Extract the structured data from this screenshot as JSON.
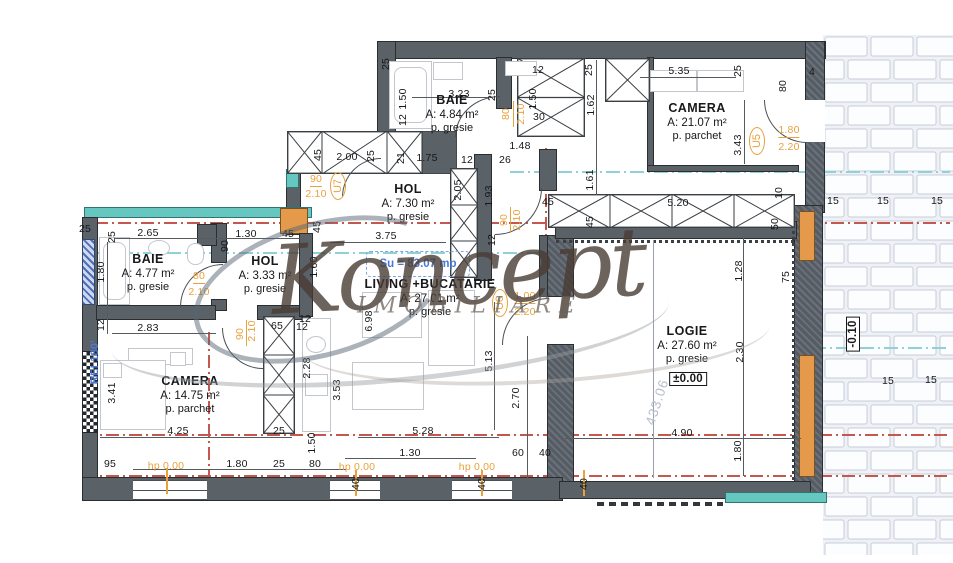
{
  "watermark": {
    "brand": "Koncept",
    "subtitle": "IMOBILIARE"
  },
  "summary": {
    "usable_area": "Su = 83.07 mp"
  },
  "colors": {
    "accent_orange": "#e8a23c",
    "accent_blue": "#4a78d6",
    "section_red": "#c4574e",
    "section_cyan": "#8ed2d8",
    "insulation_teal": "#66c7c1",
    "wall_gray": "#5a6167"
  },
  "rooms": [
    {
      "id": "baie-top",
      "name": "BAIE",
      "area": "A: 4.84 m²",
      "floor": "p. gresie",
      "x": 452,
      "y": 93
    },
    {
      "id": "camera-top",
      "name": "CAMERA",
      "area": "A: 21.07 m²",
      "floor": "p. parchet",
      "x": 697,
      "y": 101
    },
    {
      "id": "hol-top",
      "name": "HOL",
      "area": "A: 7.30 m²",
      "floor": "p. gresie",
      "x": 408,
      "y": 182
    },
    {
      "id": "baie-left",
      "name": "BAIE",
      "area": "A: 4.77 m²",
      "floor": "p. gresie",
      "x": 148,
      "y": 252
    },
    {
      "id": "hol-left",
      "name": "HOL",
      "area": "A: 3.33 m²",
      "floor": "p. gresie",
      "x": 265,
      "y": 254
    },
    {
      "id": "camera-bottom",
      "name": "CAMERA",
      "area": "A: 14.75 m²",
      "floor": "p. parchet",
      "x": 190,
      "y": 374
    },
    {
      "id": "living",
      "name": "LIVING +BUCATARIE",
      "area": "A: 27.01 m²",
      "floor": "p. gresie",
      "x": 430,
      "y": 277
    },
    {
      "id": "logie",
      "name": "LOGIE",
      "area": "A: 27.60 m²",
      "floor": "p. gresie",
      "x": 687,
      "y": 324
    }
  ],
  "door_tags": [
    {
      "label": "U5",
      "x": 757,
      "y": 141
    },
    {
      "label": "U6",
      "x": 500,
      "y": 303
    },
    {
      "label": "U7",
      "x": 338,
      "y": 186
    }
  ],
  "levels": [
    {
      "text": "±0.00",
      "x": 688,
      "y": 379,
      "r": 0
    },
    {
      "text": "-0.10",
      "x": 853,
      "y": 334,
      "r": -90
    }
  ],
  "special": [
    {
      "text": "REI 180'",
      "x": 95,
      "y": 362,
      "r": -90,
      "cls": "b"
    },
    {
      "text": "433.06",
      "x": 657,
      "y": 402,
      "r": -72,
      "cls": "g"
    }
  ],
  "dims": [
    [
      "25",
      386,
      64,
      -90
    ],
    [
      "3.23",
      459,
      94,
      0
    ],
    [
      "25",
      492,
      95,
      -90
    ],
    [
      "1.50",
      403,
      99,
      -90
    ],
    [
      "12",
      403,
      120,
      -90
    ],
    [
      "1.50",
      533,
      99,
      -90
    ],
    [
      "12",
      538,
      70,
      0
    ],
    [
      "30",
      539,
      117,
      0
    ],
    [
      "25",
      589,
      70,
      -90
    ],
    [
      "1.62",
      591,
      105,
      -90
    ],
    [
      "1.61",
      590,
      180,
      -90
    ],
    [
      "5.35",
      679,
      71,
      0
    ],
    [
      "25",
      738,
      71,
      -90
    ],
    [
      "80",
      783,
      86,
      -90
    ],
    [
      "4",
      812,
      72,
      0
    ],
    [
      "3.43",
      738,
      145,
      -90
    ],
    [
      "1.48",
      520,
      146,
      0
    ],
    [
      "26",
      505,
      160,
      0
    ],
    [
      "2.00",
      347,
      157,
      0
    ],
    [
      "25",
      371,
      156,
      -90
    ],
    [
      "45",
      318,
      155,
      -90
    ],
    [
      "21",
      401,
      158,
      -90
    ],
    [
      "1.75",
      427,
      158,
      0
    ],
    [
      "12",
      467,
      160,
      0
    ],
    [
      "2.05",
      458,
      190,
      -90
    ],
    [
      "1.93",
      489,
      196,
      -90
    ],
    [
      "12",
      492,
      240,
      -90
    ],
    [
      "45",
      317,
      227,
      -90
    ],
    [
      "3.75",
      386,
      236,
      0
    ],
    [
      "25",
      85,
      229,
      0
    ],
    [
      "25",
      112,
      237,
      -90
    ],
    [
      "2.65",
      148,
      233,
      0
    ],
    [
      "1.30",
      246,
      234,
      0
    ],
    [
      "45",
      288,
      234,
      0
    ],
    [
      "90",
      225,
      246,
      -90
    ],
    [
      "1.80",
      101,
      272,
      -90
    ],
    [
      "12",
      101,
      325,
      -90
    ],
    [
      "2.83",
      148,
      328,
      0
    ],
    [
      "65",
      277,
      326,
      0
    ],
    [
      "12",
      302,
      327,
      0
    ],
    [
      "3.41",
      112,
      393,
      -90
    ],
    [
      "4.25",
      178,
      431,
      0
    ],
    [
      "25",
      279,
      431,
      0
    ],
    [
      "2.28",
      307,
      368,
      -90
    ],
    [
      "1.50",
      312,
      443,
      -90
    ],
    [
      "95",
      110,
      464,
      0
    ],
    [
      "1.80",
      237,
      464,
      0
    ],
    [
      "25",
      279,
      464,
      0
    ],
    [
      "80",
      315,
      464,
      0
    ],
    [
      "1.60",
      314,
      267,
      -90
    ],
    [
      "12",
      305,
      319,
      0
    ],
    [
      "6.98",
      369,
      321,
      -90
    ],
    [
      "3.53",
      337,
      390,
      -90
    ],
    [
      "5.28",
      423,
      431,
      0
    ],
    [
      "1.30",
      410,
      453,
      0
    ],
    [
      "5.13",
      489,
      361,
      -90
    ],
    [
      "2.70",
      516,
      398,
      -90
    ],
    [
      "60",
      518,
      453,
      0
    ],
    [
      "40",
      545,
      453,
      0
    ],
    [
      "40",
      356,
      484,
      -90
    ],
    [
      "40",
      482,
      484,
      -90
    ],
    [
      "40",
      584,
      484,
      -90
    ],
    [
      "45",
      548,
      202,
      0
    ],
    [
      "45",
      590,
      222,
      -90
    ],
    [
      "5.20",
      678,
      203,
      0
    ],
    [
      "10",
      779,
      193,
      -90
    ],
    [
      "50",
      775,
      224,
      -90
    ],
    [
      "1.28",
      739,
      271,
      -90
    ],
    [
      "2.30",
      740,
      352,
      -90
    ],
    [
      "75",
      786,
      277,
      -90
    ],
    [
      "4.90",
      682,
      433,
      0
    ],
    [
      "1.80",
      738,
      451,
      -90
    ],
    [
      "15",
      833,
      201,
      0
    ],
    [
      "15",
      883,
      201,
      0
    ],
    [
      "15",
      937,
      201,
      0
    ],
    [
      "15",
      888,
      381,
      0
    ],
    [
      "15",
      931,
      380,
      0
    ]
  ],
  "door_sizes": [
    [
      "80",
      506,
      114,
      -90,
      false
    ],
    [
      "2.10",
      521,
      114,
      -90,
      false
    ],
    [
      "90",
      316,
      180,
      0,
      true
    ],
    [
      "2.10",
      316,
      194,
      0,
      false
    ],
    [
      "80",
      199,
      277,
      0,
      true
    ],
    [
      "2.10",
      199,
      292,
      0,
      false
    ],
    [
      "90",
      240,
      334,
      -90,
      false
    ],
    [
      "2.10",
      252,
      331,
      -90,
      false
    ],
    [
      "90",
      504,
      220,
      -90,
      false
    ],
    [
      "2.10",
      517,
      220,
      -90,
      false
    ],
    [
      "1.80",
      789,
      131,
      0,
      true
    ],
    [
      "2.20",
      789,
      147,
      0,
      false
    ],
    [
      "1.00",
      525,
      297,
      0,
      true
    ],
    [
      "2.20",
      525,
      312,
      0,
      false
    ]
  ],
  "hp_labels": [
    {
      "text": "hp 0.00",
      "x": 166,
      "y": 466
    },
    {
      "text": "hp 0.00",
      "x": 357,
      "y": 467
    },
    {
      "text": "hp 0.00",
      "x": 477,
      "y": 467
    }
  ]
}
